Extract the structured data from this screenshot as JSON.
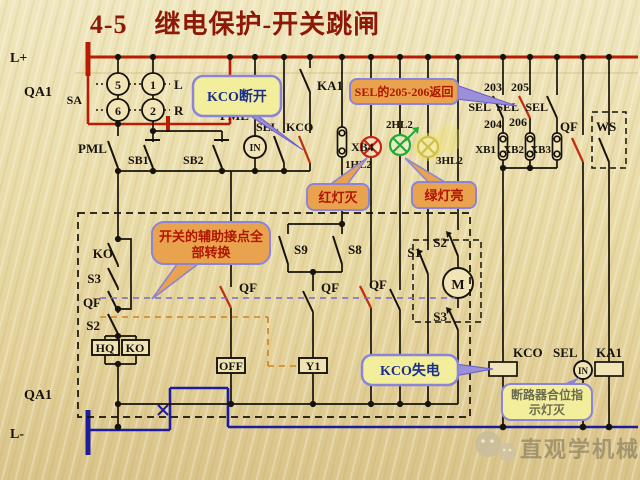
{
  "title": "4-5　继电保护-开关跳闸",
  "colors": {
    "bus_positive": "#b91c04",
    "bus_negative": "#1c1c9c",
    "wire": "#17130c",
    "tripped_contact": "#c03010",
    "callout_yellow": "#f2ee9b",
    "callout_orange": "#e9a34f",
    "callout_border": "#8b84d8",
    "lamp_red": "#cc2211",
    "lamp_green": "#22aa33",
    "lamp_yellow": "#cfc04a",
    "background": "#e9dba6"
  },
  "power": {
    "l_plus": "L+",
    "qa1_top": "QA1",
    "qa1_bottom": "QA1",
    "l_minus": "L-"
  },
  "sa": {
    "label": "SA",
    "c5": "5",
    "c1": "1",
    "c6": "6",
    "c2": "2",
    "left": "L",
    "right": "R"
  },
  "top": {
    "pml_left": "PML",
    "sb1": "SB1",
    "sb2": "SB2",
    "pml_lamp": "PML",
    "in_lamp": "IN",
    "sel": "SEL",
    "kco": "KCO",
    "ka1": "KA1",
    "xb4": "XB4",
    "hl1": "1HL2",
    "hl2": "2HL2",
    "hl3": "3HL2"
  },
  "right": {
    "n203": "203",
    "n205": "205",
    "sel1": "SEL",
    "sel2": "SEL",
    "sel3": "SEL",
    "n204": "204",
    "n206": "206",
    "xb1": "XB1",
    "xb2": "XB2",
    "xb3": "XB3",
    "qf": "QF",
    "ws": "WS"
  },
  "box": {
    "ko_switch": "KO",
    "s3_left": "S3",
    "qf_left": "QF",
    "s2_left": "S2",
    "qf_a": "QF",
    "qf_b": "QF",
    "qf_c": "QF",
    "s9": "S9",
    "s8": "S8",
    "s1": "S1",
    "s2_right": "S2",
    "s3_right": "S3",
    "motor": "M",
    "hq": "HQ",
    "ko_box": "KO",
    "off": "OFF",
    "y1": "Y1"
  },
  "bottom": {
    "kco": "KCO",
    "sel": "SEL",
    "ka1": "KA1",
    "in_lamp": "IN"
  },
  "callouts": {
    "kco_open": "KCO断开",
    "sel_return": "SEL的205-206返回",
    "aux1": "开关的辅助接点全",
    "aux2": "部转换",
    "red_lamp": "红灯灭",
    "green_lamp": "绿灯亮",
    "kco_loss": "KCO失电",
    "breaker1": "断路器合位指",
    "breaker2": "示灯灭"
  },
  "watermark": "直观学机械"
}
